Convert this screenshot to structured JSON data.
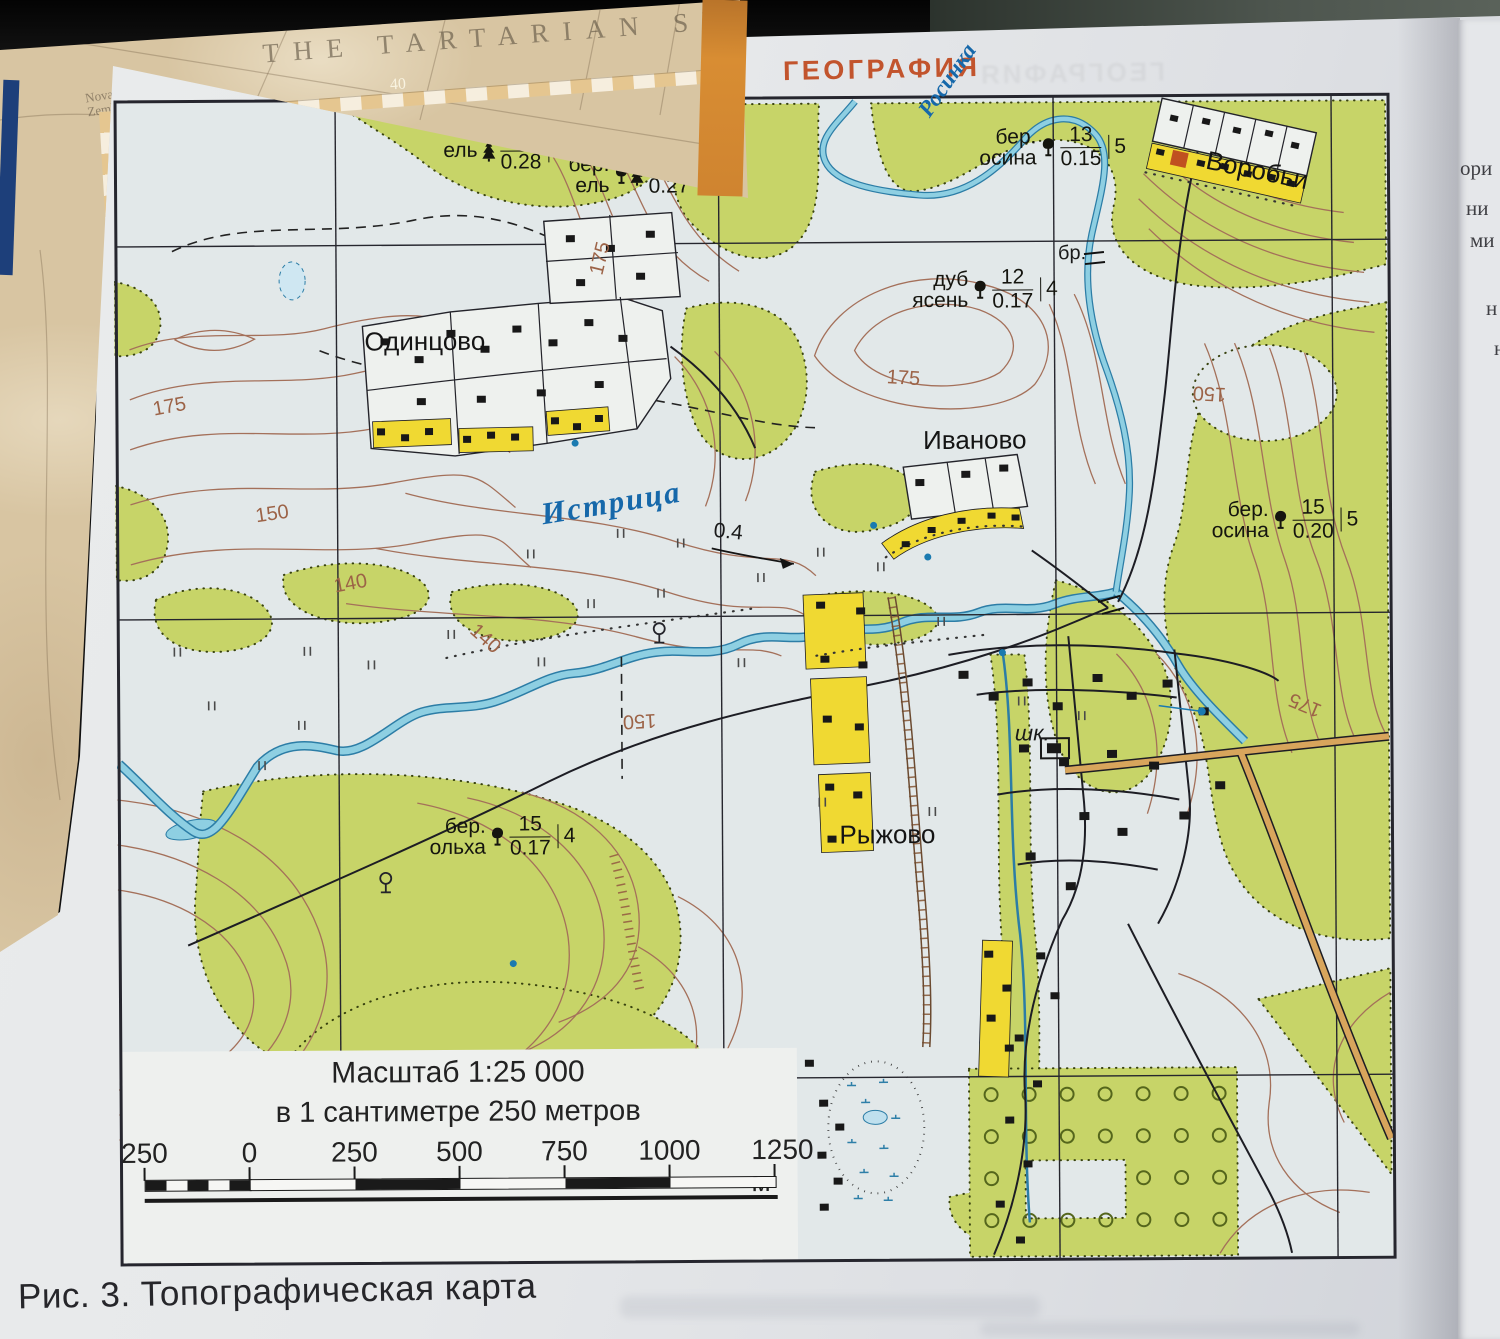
{
  "page": {
    "header": "ГЕОГРАФИЯ",
    "caption": "Рис. 3. Топографическая карта"
  },
  "old_map": {
    "title": "THE TARTARIAN SEA",
    "place": "Nova Zembla",
    "num1": "40",
    "num2": "35"
  },
  "adjacent_page_fragments": [
    "ори",
    "ни",
    "ми",
    "н",
    "н"
  ],
  "map": {
    "villages": {
      "odintsovo": "Одинцово",
      "ivanovo": "Иваново",
      "vorobyi": "Воробьи",
      "ryzhovo": "Рыжово"
    },
    "rivers": {
      "istritsa": "Истрица",
      "rosinka": "Росинка",
      "river_depth": "0.4"
    },
    "labels": {
      "bridge": "бр.",
      "school": "шк."
    },
    "contour_labels": [
      "175",
      "150",
      "140",
      "175",
      "175",
      "150",
      "140",
      "150",
      "175"
    ],
    "stands": [
      {
        "line1": "ель",
        "line2": "",
        "top": "15",
        "bottom": "0.28",
        "side": "7"
      },
      {
        "line1": "бер.",
        "line2": "ель",
        "top": "17",
        "bottom": "0.27",
        "side": "5"
      },
      {
        "line1": "бер.",
        "line2": "осина",
        "top": "13",
        "bottom": "0.15",
        "side": "5"
      },
      {
        "line1": "дуб",
        "line2": "ясень",
        "top": "12",
        "bottom": "0.17",
        "side": "4"
      },
      {
        "line1": "бер.",
        "line2": "осина",
        "top": "15",
        "bottom": "0.20",
        "side": "5"
      },
      {
        "line1": "бер.",
        "line2": "ольха",
        "top": "15",
        "bottom": "0.17",
        "side": "4"
      }
    ],
    "scale": {
      "title": "Масштаб 1:25 000",
      "subtitle": "в 1 сантиметре 250 метров",
      "ticks": [
        "250",
        "0",
        "250",
        "500",
        "750",
        "1000",
        "1250 м"
      ]
    },
    "colors": {
      "forest": "#c7d468",
      "open": "#e2e8e9",
      "water_fill": "#8ecfe2",
      "water_edge": "#2c7da6",
      "contour": "#a4705a",
      "settlement": "#f0d932",
      "highway": "#d8a55c",
      "frame": "#26262e",
      "header_accent": "#c2542d"
    }
  }
}
